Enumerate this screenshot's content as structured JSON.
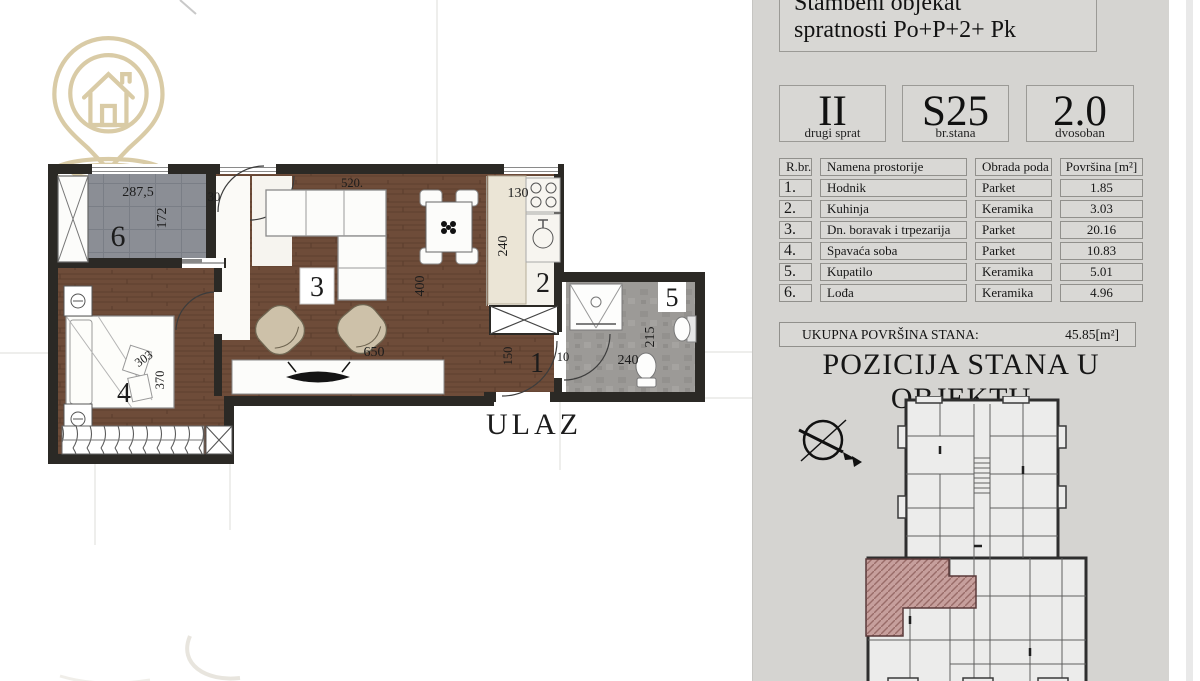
{
  "icons": {
    "watermark": "house-location-pin-logo",
    "compass": "north-arrow-compass"
  },
  "floorplan": {
    "entrance_label": "ULAZ",
    "room_numbers": {
      "hodnik": "1",
      "kuhinja": "2",
      "boravak": "3",
      "spavaca_soba": "4",
      "kupatilo": "5",
      "lodja": "6"
    },
    "dims": {
      "loggia_width": "287,5",
      "loggia_depth": "172",
      "vestibule_width": "30",
      "sofa_width": "520.",
      "kitchen_width": "130",
      "kitchen_depth": "240",
      "dining_depth": "400",
      "living_width": "650",
      "hall_depth": "150",
      "hall_width": "10",
      "bed_width": "303",
      "bed_length": "370",
      "bath_width": "240",
      "bath_depth": "215"
    }
  },
  "panel": {
    "title_lines": [
      "Stambeni objekat",
      "spratnosti Po+P+2+ Pk"
    ],
    "info_boxes": [
      {
        "value": "II",
        "label": "drugi sprat"
      },
      {
        "value": "S25",
        "label": "br.stana"
      },
      {
        "value": "2.0",
        "label": "dvosoban"
      }
    ],
    "table": {
      "headers": [
        "R.br.",
        "Namena prostorije",
        "Obrada poda",
        "Površina [m²]"
      ],
      "rows": [
        {
          "num": "1.",
          "name": "Hodnik",
          "floor": "Parket",
          "area": "1.85"
        },
        {
          "num": "2.",
          "name": "Kuhinja",
          "floor": "Keramika",
          "area": "3.03"
        },
        {
          "num": "3.",
          "name": "Dn. boravak i trpezarija",
          "floor": "Parket",
          "area": "20.16"
        },
        {
          "num": "4.",
          "name": "Spavaća soba",
          "floor": "Parket",
          "area": "10.83"
        },
        {
          "num": "5.",
          "name": "Kupatilo",
          "floor": "Keramika",
          "area": "5.01"
        },
        {
          "num": "6.",
          "name": "Lođa",
          "floor": "Keramika",
          "area": "4.96"
        }
      ]
    },
    "total": {
      "label": "UKUPNA POVRŠINA STANA:",
      "value": "45.85[m²]"
    },
    "position_title": "POZICIJA STANA U OBJEKTU"
  }
}
